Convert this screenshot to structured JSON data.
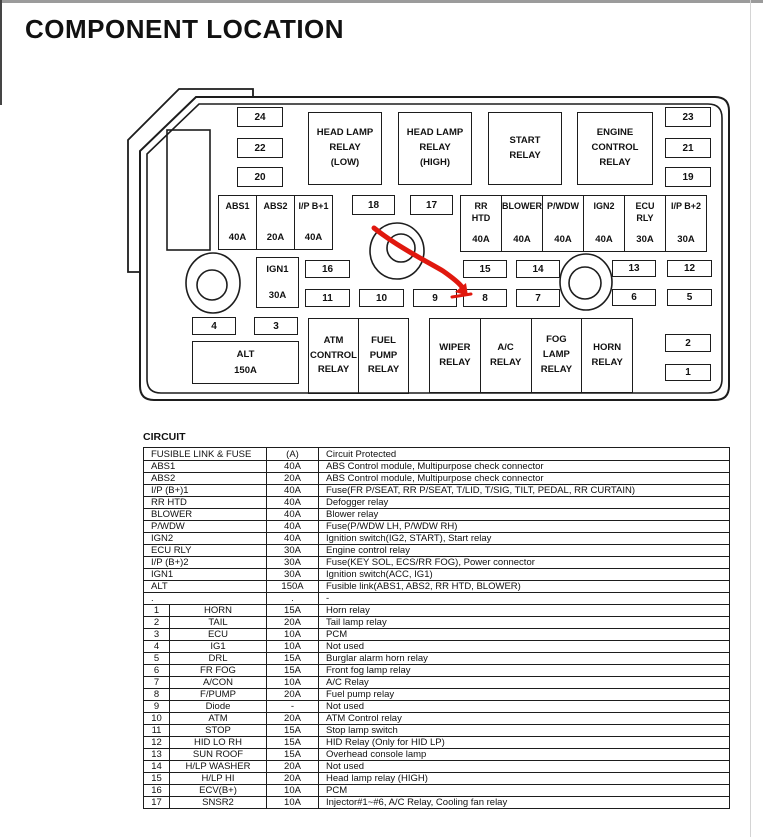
{
  "page": {
    "title": "COMPONENT LOCATION"
  },
  "diagram": {
    "annotation_color": "#e0180e",
    "relays": {
      "head_lamp_low": "HEAD LAMP\nRELAY\n(LOW)",
      "head_lamp_high": "HEAD LAMP\nRELAY\n(HIGH)",
      "start": "START\nRELAY",
      "engine_control": "ENGINE\nCONTROL\nRELAY",
      "atm_control": "ATM\nCONTROL\nRELAY",
      "fuel_pump": "FUEL\nPUMP\nRELAY",
      "wiper": "WIPER\nRELAY",
      "ac": "A/C\nRELAY",
      "fog_lamp": "FOG\nLAMP\nRELAY",
      "horn": "HORN\nRELAY"
    },
    "fusible_links": {
      "abs1": {
        "name": "ABS1",
        "amp": "40A"
      },
      "abs2": {
        "name": "ABS2",
        "amp": "20A"
      },
      "ip_b1": {
        "name": "I/P B+1",
        "amp": "40A"
      },
      "rr_htd": {
        "name": "RR\nHTD",
        "amp": "40A"
      },
      "blower": {
        "name": "BLOWER",
        "amp": "40A"
      },
      "pwdw": {
        "name": "P/WDW",
        "amp": "40A"
      },
      "ign2": {
        "name": "IGN2",
        "amp": "40A"
      },
      "ecu_rly": {
        "name": "ECU\nRLY",
        "amp": "30A"
      },
      "ip_b2": {
        "name": "I/P B+2",
        "amp": "30A"
      },
      "ign1": {
        "name": "IGN1",
        "amp": "30A"
      },
      "alt": {
        "name": "ALT",
        "amp": "150A"
      }
    },
    "small_fuses": {
      "f1": "1",
      "f2": "2",
      "f3": "3",
      "f4": "4",
      "f5": "5",
      "f6": "6",
      "f7": "7",
      "f8": "8",
      "f9": "9",
      "f10": "10",
      "f11": "11",
      "f12": "12",
      "f13": "13",
      "f14": "14",
      "f15": "15",
      "f16": "16",
      "f17": "17",
      "f18": "18",
      "f19": "19",
      "f20": "20",
      "f21": "21",
      "f22": "22",
      "f23": "23",
      "f24": "24"
    }
  },
  "table": {
    "section_label": "CIRCUIT",
    "header": {
      "col1": "FUSIBLE LINK & FUSE",
      "col2": "(A)",
      "col3": "Circuit Protected"
    },
    "link_rows": [
      {
        "name": "ABS1",
        "amp": "40A",
        "circuit": "ABS Control module, Multipurpose check connector"
      },
      {
        "name": "ABS2",
        "amp": "20A",
        "circuit": "ABS Control module, Multipurpose check connector"
      },
      {
        "name": "I/P (B+)1",
        "amp": "40A",
        "circuit": "Fuse(FR P/SEAT, RR P/SEAT, T/LID, T/SIG, TILT, PEDAL, RR CURTAIN)"
      },
      {
        "name": "RR HTD",
        "amp": "40A",
        "circuit": "Defogger relay"
      },
      {
        "name": "BLOWER",
        "amp": "40A",
        "circuit": "Blower relay"
      },
      {
        "name": "P/WDW",
        "amp": "40A",
        "circuit": "Fuse(P/WDW LH, P/WDW RH)"
      },
      {
        "name": "IGN2",
        "amp": "40A",
        "circuit": "Ignition switch(IG2, START), Start relay"
      },
      {
        "name": "ECU RLY",
        "amp": "30A",
        "circuit": "Engine control relay"
      },
      {
        "name": "I/P (B+)2",
        "amp": "30A",
        "circuit": "Fuse(KEY SOL, ECS/RR FOG), Power connector"
      },
      {
        "name": "IGN1",
        "amp": "30A",
        "circuit": "Ignition switch(ACC, IG1)"
      },
      {
        "name": "ALT",
        "amp": "150A",
        "circuit": "Fusible link(ABS1, ABS2, RR HTD, BLOWER)"
      },
      {
        "name": ".",
        "amp": ".",
        "circuit": "-"
      }
    ],
    "fuse_rows": [
      {
        "no": "1",
        "name": "HORN",
        "amp": "15A",
        "circuit": "Horn relay"
      },
      {
        "no": "2",
        "name": "TAIL",
        "amp": "20A",
        "circuit": "Tail lamp relay"
      },
      {
        "no": "3",
        "name": "ECU",
        "amp": "10A",
        "circuit": "PCM"
      },
      {
        "no": "4",
        "name": "IG1",
        "amp": "10A",
        "circuit": "Not used"
      },
      {
        "no": "5",
        "name": "DRL",
        "amp": "15A",
        "circuit": "Burglar alarm horn relay"
      },
      {
        "no": "6",
        "name": "FR FOG",
        "amp": "15A",
        "circuit": "Front fog lamp relay"
      },
      {
        "no": "7",
        "name": "A/CON",
        "amp": "10A",
        "circuit": "A/C Relay"
      },
      {
        "no": "8",
        "name": "F/PUMP",
        "amp": "20A",
        "circuit": "Fuel pump relay"
      },
      {
        "no": "9",
        "name": "Diode",
        "amp": "-",
        "circuit": "Not used"
      },
      {
        "no": "10",
        "name": "ATM",
        "amp": "20A",
        "circuit": "ATM Control relay"
      },
      {
        "no": "11",
        "name": "STOP",
        "amp": "15A",
        "circuit": "Stop lamp switch"
      },
      {
        "no": "12",
        "name": "HID LO RH",
        "amp": "15A",
        "circuit": "HID Relay (Only for HID LP)"
      },
      {
        "no": "13",
        "name": "SUN ROOF",
        "amp": "15A",
        "circuit": "Overhead console lamp"
      },
      {
        "no": "14",
        "name": "H/LP WASHER",
        "amp": "20A",
        "circuit": "Not used"
      },
      {
        "no": "15",
        "name": "H/LP HI",
        "amp": "20A",
        "circuit": "Head lamp relay (HIGH)"
      },
      {
        "no": "16",
        "name": "ECV(B+)",
        "amp": "10A",
        "circuit": "PCM"
      },
      {
        "no": "17",
        "name": "SNSR2",
        "amp": "10A",
        "circuit": "Injector#1~#6, A/C Relay, Cooling fan relay"
      }
    ]
  }
}
